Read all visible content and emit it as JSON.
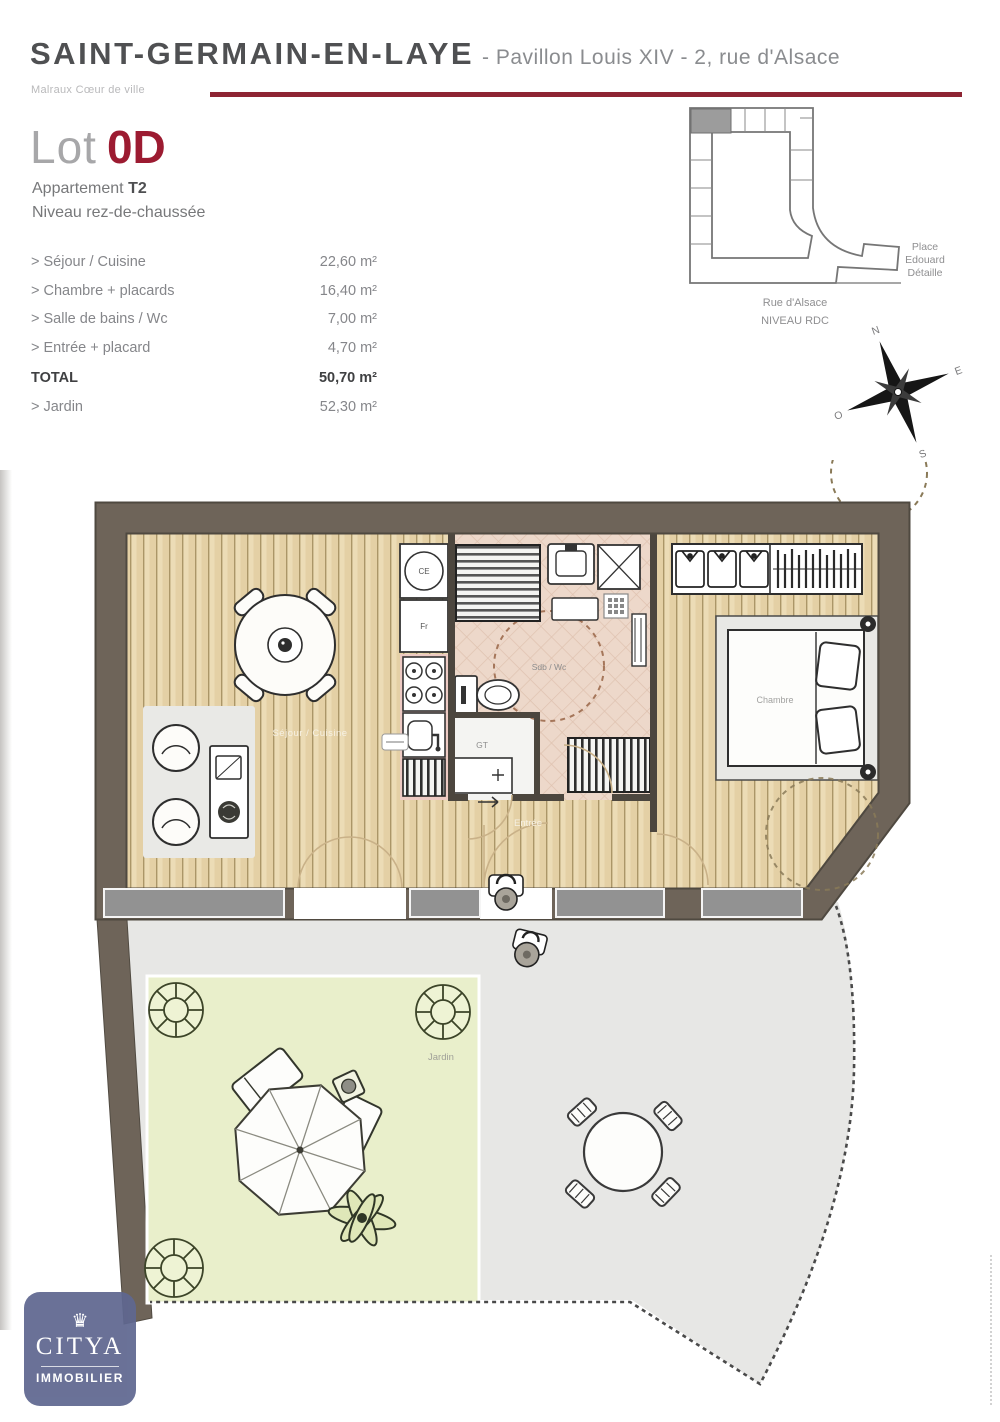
{
  "header": {
    "city": "SAINT-GERMAIN-EN-LAYE",
    "subtitle": "- Pavillon Louis XIV - 2, rue d'Alsace",
    "program": "Malraux Cœur de ville"
  },
  "lot": {
    "label": "Lot",
    "number": "0D",
    "apartment_label": "Appartement",
    "apartment_type": "T2",
    "level": "Niveau rez-de-chaussée"
  },
  "surfaces": {
    "rows": [
      {
        "label": "> Séjour / Cuisine",
        "value": "22,60 m²"
      },
      {
        "label": "> Chambre + placards",
        "value": "16,40 m²"
      },
      {
        "label": "> Salle de bains / Wc",
        "value": "7,00 m²"
      },
      {
        "label": "> Entrée + placard",
        "value": "4,70 m²"
      }
    ],
    "total_label": "TOTAL",
    "total_value": "50,70 m²",
    "jardin_label": "> Jardin",
    "jardin_value": "52,30 m²"
  },
  "minimap": {
    "street": "Rue d'Alsace",
    "level": "NIVEAU RDC",
    "place_lines": [
      "Place",
      "Edouard",
      "Détaille"
    ],
    "compass": {
      "n": "N",
      "e": "E",
      "s": "S",
      "o": "O"
    }
  },
  "plan": {
    "labels": {
      "sejour": "Séjour / Cuisine",
      "sdb": "Sdb / Wc",
      "entree": "Entrée",
      "chambre": "Chambre",
      "gt": "GT",
      "ce": "CE",
      "fr": "Fr",
      "jardin": "Jardin"
    }
  },
  "logo": {
    "brand": "CITYA",
    "tagline": "IMMOBILIER"
  },
  "colors": {
    "accent": "#8e2433",
    "wall": "#6e6459",
    "lot_red": "#9c1b31",
    "logo_bg": "#5f6790",
    "wood": "#ecdcb6",
    "tile": "#edd8ca",
    "garden": "#e9efcb",
    "terrace": "#e7e7e5"
  }
}
